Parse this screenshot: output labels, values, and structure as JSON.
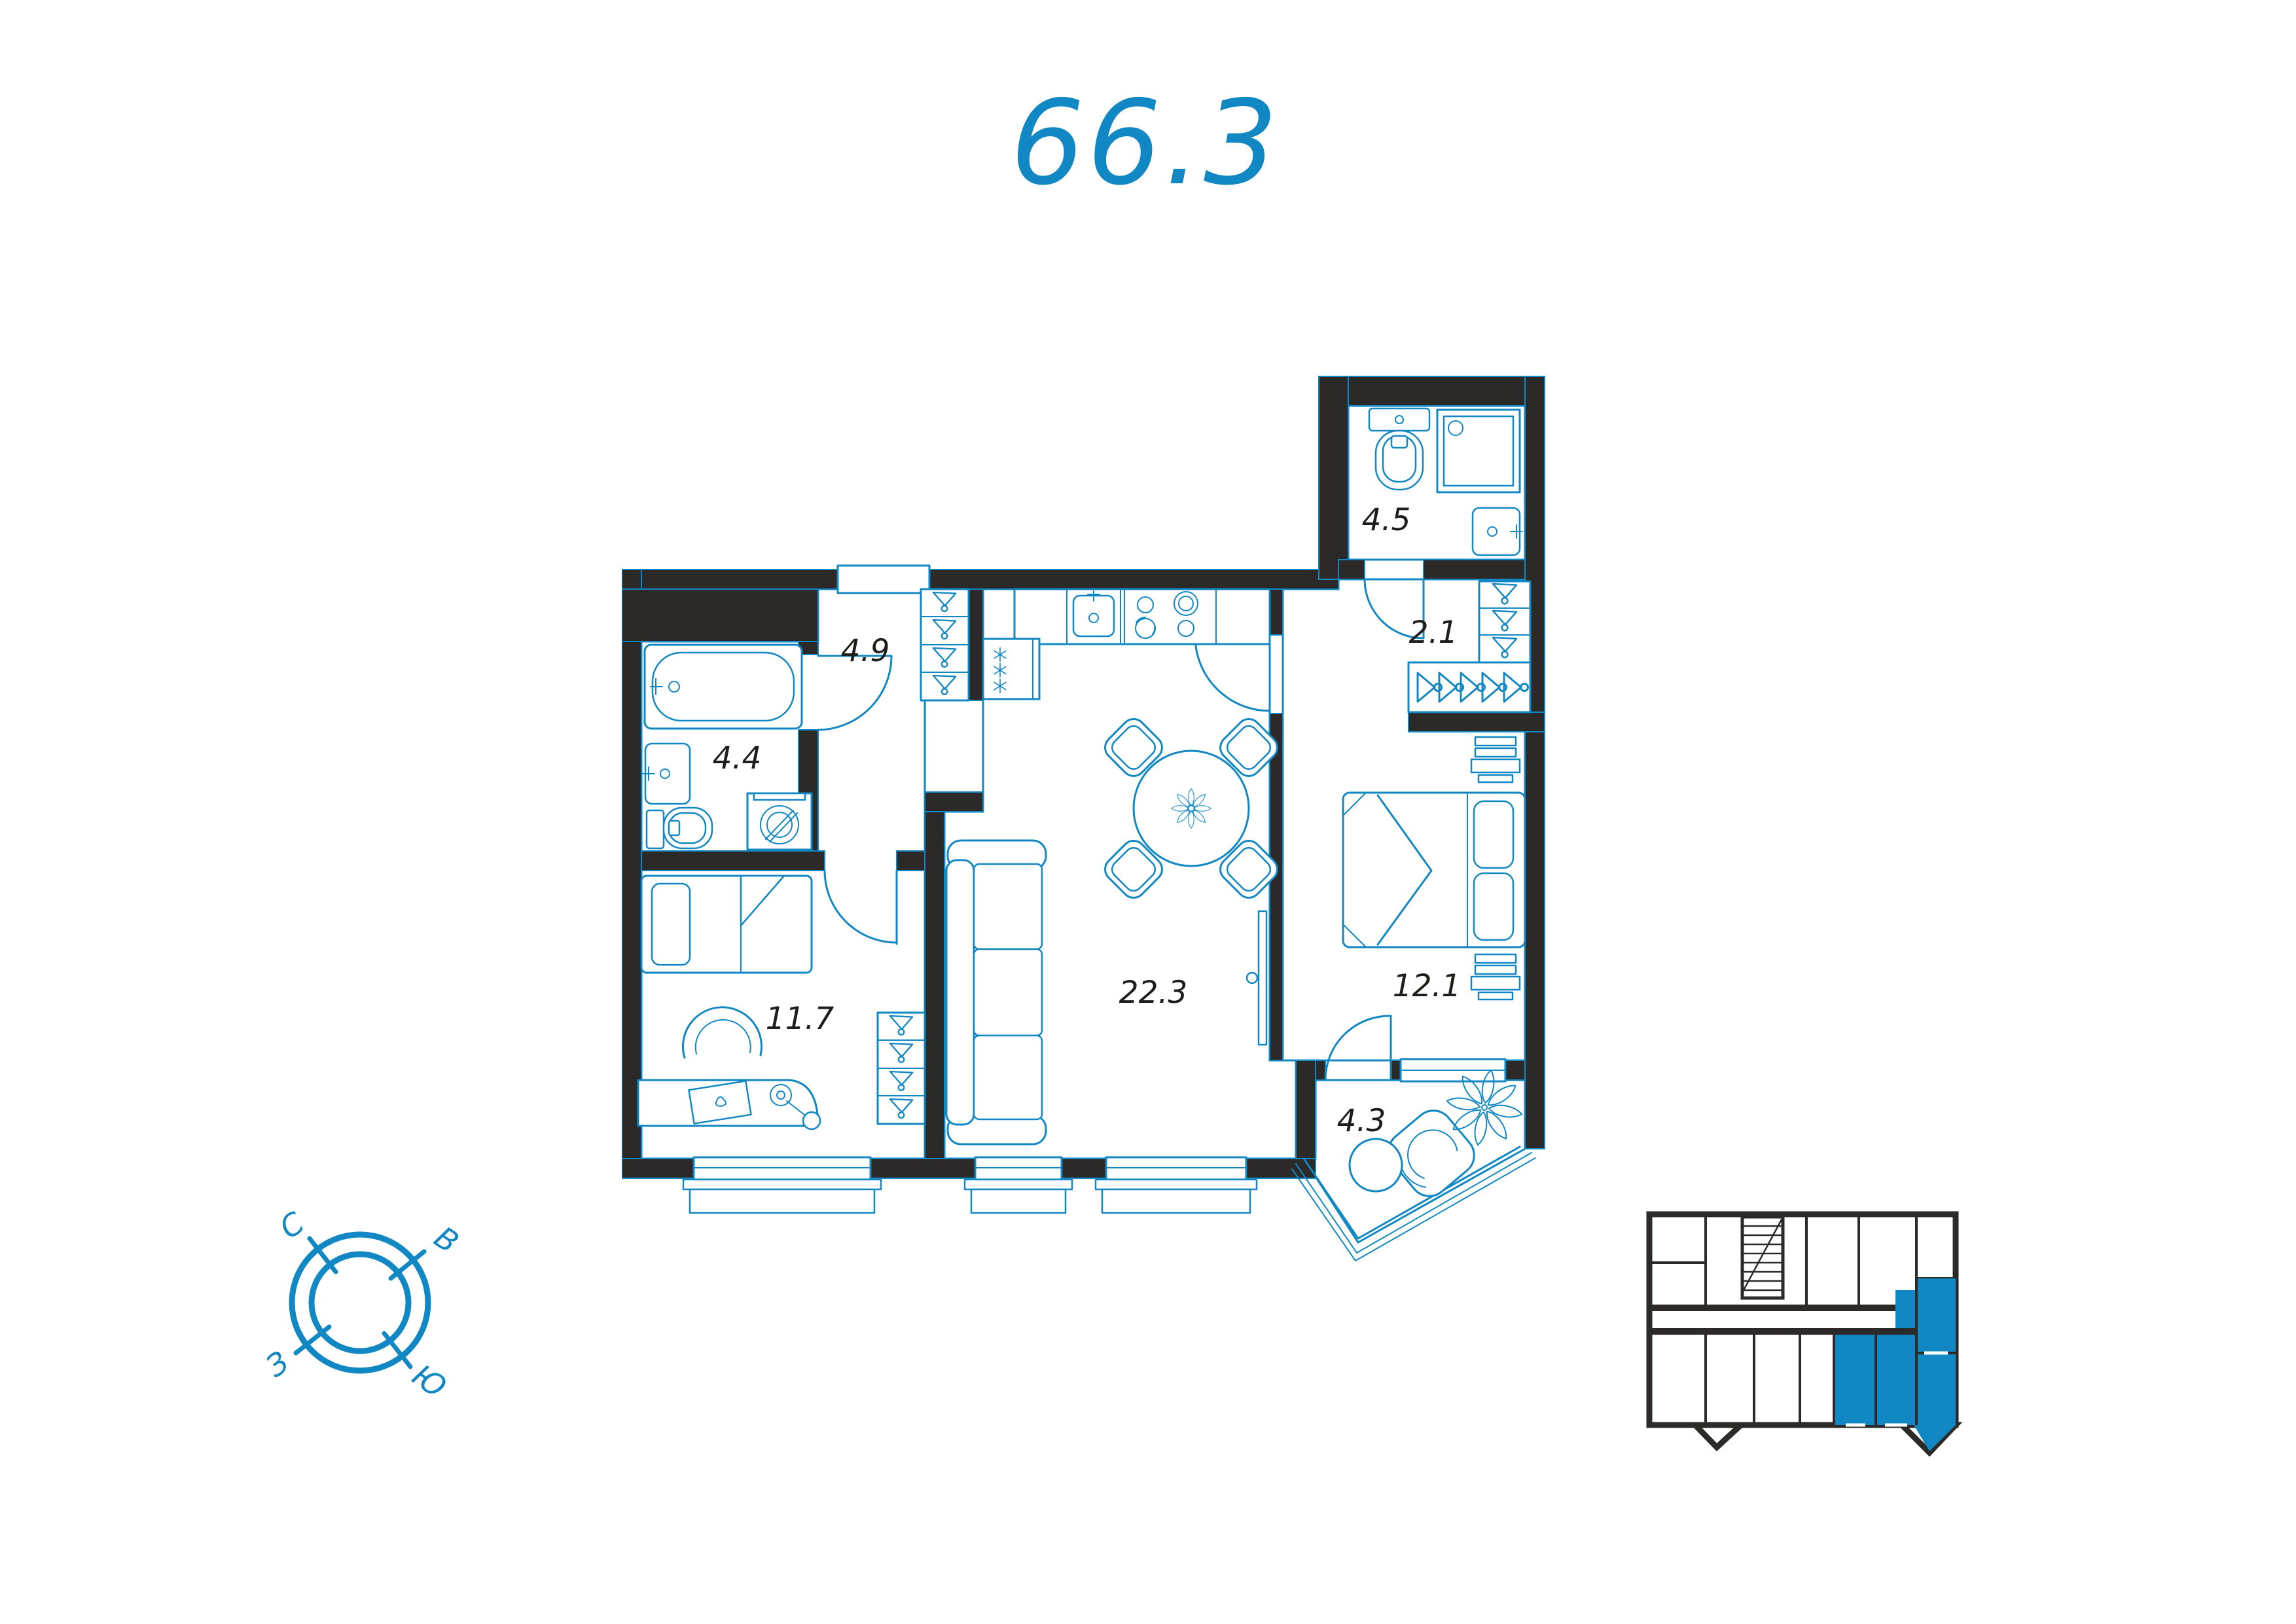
{
  "title": "66.3",
  "colors": {
    "accent_blue": "#1187c3",
    "wall_dark": "#2b2a29",
    "label_black": "#1d1d1b",
    "background": "#ffffff"
  },
  "rooms": {
    "bathroom_top": {
      "area": "4.5"
    },
    "closet": {
      "area": "2.1"
    },
    "hallway": {
      "area": "4.9"
    },
    "bathroom": {
      "area": "4.4"
    },
    "bedroom_small": {
      "area": "11.7"
    },
    "living_kitchen": {
      "area": "22.3"
    },
    "bedroom": {
      "area": "12.1"
    },
    "balcony": {
      "area": "4.3"
    }
  },
  "compass": {
    "north": "С",
    "east": "В",
    "west": "З",
    "south": "Ю"
  }
}
